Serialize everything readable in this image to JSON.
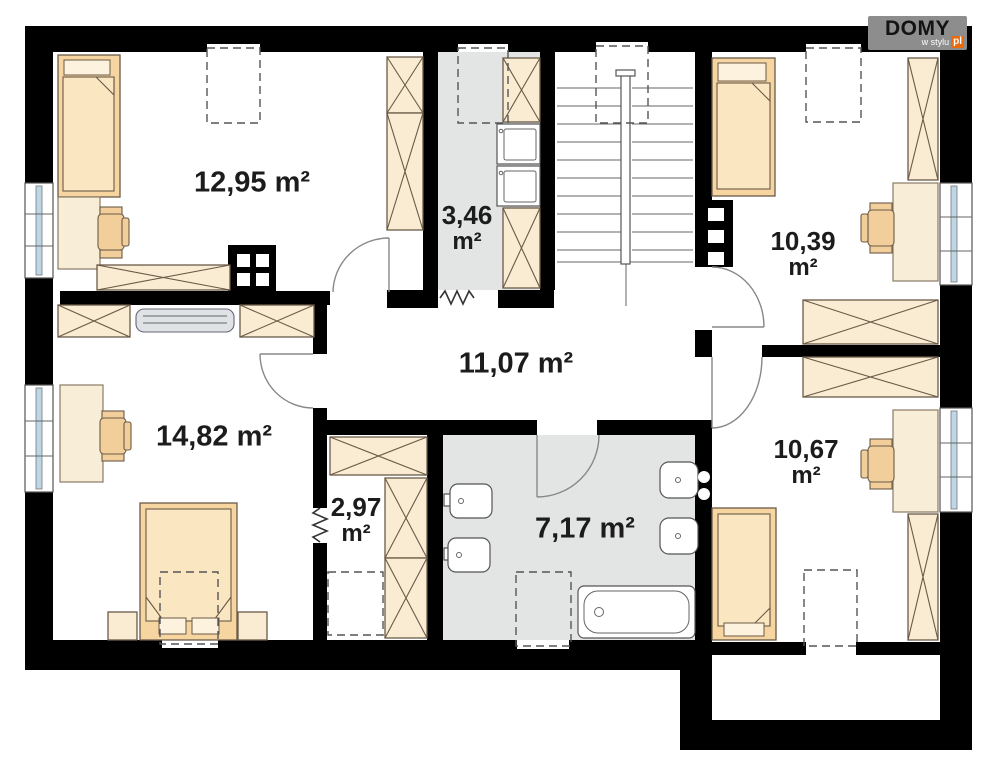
{
  "logo": {
    "brand": "DOMY",
    "tagline": "w stylu",
    "tld": "pl"
  },
  "rooms": [
    {
      "id": "bedroom-upper-left",
      "value": "12,95",
      "unit": "m²"
    },
    {
      "id": "utility-room",
      "value": "3,46",
      "unit": "m²"
    },
    {
      "id": "bedroom-upper-right",
      "value": "10,39",
      "unit": "m²"
    },
    {
      "id": "hall",
      "value": "11,07",
      "unit": "m²"
    },
    {
      "id": "bedroom-lower-left",
      "value": "14,82",
      "unit": "m²"
    },
    {
      "id": "wardrobe-closet",
      "value": "2,97",
      "unit": "m²"
    },
    {
      "id": "bathroom",
      "value": "7,17",
      "unit": "m²"
    },
    {
      "id": "bedroom-lower-right",
      "value": "10,67",
      "unit": "m²"
    }
  ],
  "palette": {
    "wall": "#000000",
    "floor_gray": "#e3e5e4",
    "furniture_cream": "#faecd2",
    "bed_tan": "#f6d5a0",
    "bed_inner": "#fae6c1",
    "chair_tan": "#f2cf9a",
    "window_glass": "#bdd7e7",
    "outline_brown": "#6a5a48",
    "brand_orange": "#e96b10",
    "brand_gray": "#8d8d8d",
    "label_color": "#1c1c1c"
  }
}
